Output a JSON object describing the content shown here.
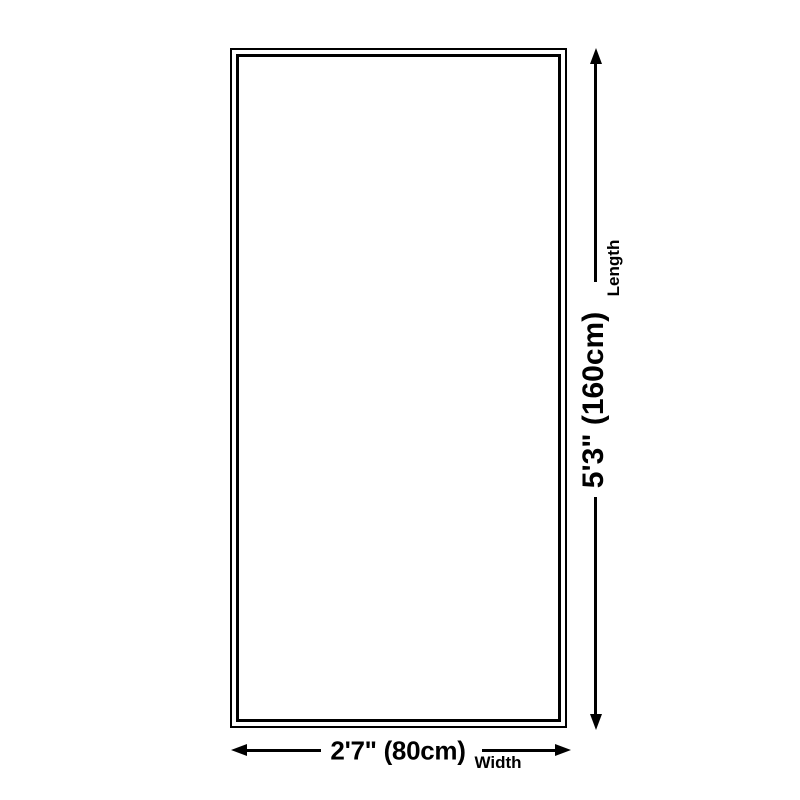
{
  "diagram": {
    "title": "rug-size-dimension-diagram",
    "length": {
      "value": "5'3\" (160cm)",
      "axis_label": "Length"
    },
    "width": {
      "value": "2'7\" (80cm)",
      "axis_label": "Width"
    },
    "icons": {
      "vertical_arrow": "double-headed-arrow-vertical",
      "horizontal_arrow": "double-headed-arrow-horizontal"
    },
    "colors": {
      "ink": "#000000",
      "background": "#ffffff"
    }
  }
}
